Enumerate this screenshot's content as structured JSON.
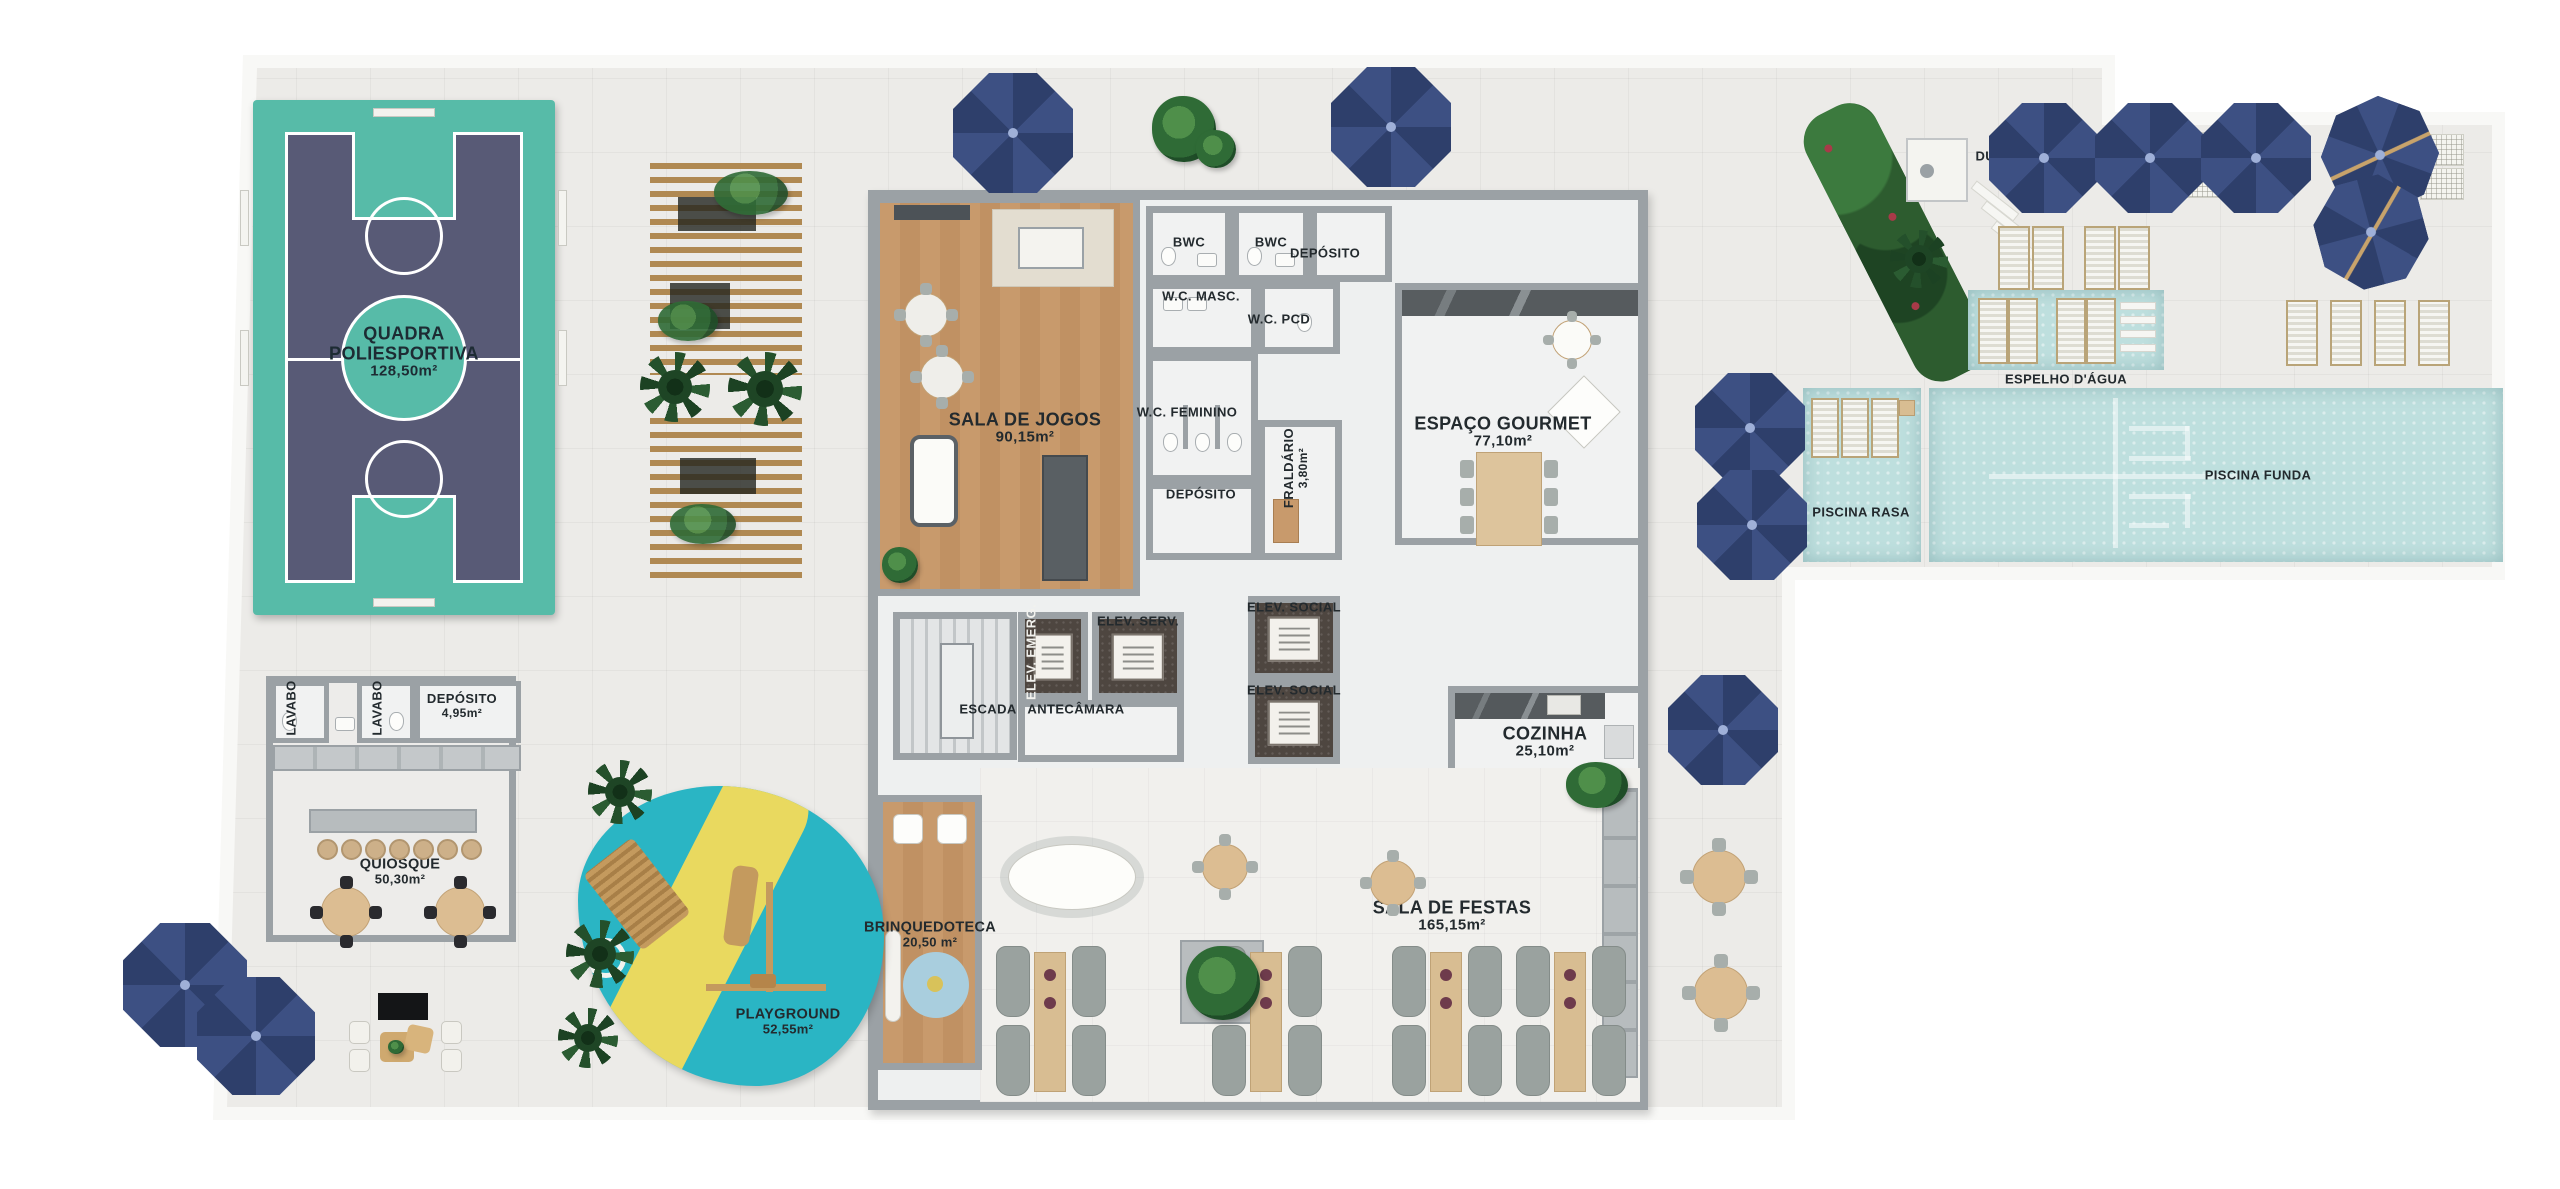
{
  "plan_title": "Pavimento de lazer - planta humanizada",
  "rooms": {
    "quadra": {
      "name": "QUADRA POLIESPORTIVA",
      "area": "128,50m²"
    },
    "sala_jogos": {
      "name": "SALA DE JOGOS",
      "area": "90,15m²"
    },
    "bwc1": {
      "name": "BWC"
    },
    "bwc2": {
      "name": "BWC"
    },
    "deposito_top": {
      "name": "DEPÓSITO"
    },
    "wc_masc": {
      "name": "W.C. MASC."
    },
    "wc_pcd": {
      "name": "W.C. PCD"
    },
    "wc_fem": {
      "name": "W.C. FEMININO"
    },
    "deposito_mid": {
      "name": "DEPÓSITO"
    },
    "fraldario": {
      "name": "FRALDÁRIO",
      "area": "3,80m²"
    },
    "espaco_gourmet": {
      "name": "ESPAÇO GOURMET",
      "area": "77,10m²"
    },
    "escada": {
      "name": "ESCADA"
    },
    "antecamara": {
      "name": "ANTECÂMARA"
    },
    "elev_emerg": {
      "name": "ELEV. EMERG."
    },
    "elev_serv": {
      "name": "ELEV. SERV."
    },
    "elev_social_1": {
      "name": "ELEV. SOCIAL"
    },
    "elev_social_2": {
      "name": "ELEV. SOCIAL"
    },
    "cozinha": {
      "name": "COZINHA",
      "area": "25,10m²"
    },
    "sala_festas": {
      "name": "SALA DE FESTAS",
      "area": "165,15m²"
    },
    "brinquedoteca": {
      "name": "BRINQUEDOTECA",
      "area": "20,50 m²"
    },
    "playground": {
      "name": "PLAYGROUND",
      "area": "52,55m²"
    },
    "quiosque": {
      "name": "QUIOSQUE",
      "area": "50,30m²"
    },
    "lavabo1": {
      "name": "LAVABO"
    },
    "lavabo2": {
      "name": "LAVABO"
    },
    "deposito_quiosque": {
      "name": "DEPÓSITO",
      "area": "4,95m²"
    },
    "ducha": {
      "name": "DUCHA"
    },
    "espelho_dagua": {
      "name": "ESPELHO D'ÁGUA"
    },
    "piscina_rasa": {
      "name": "PISCINA RASA"
    },
    "piscina_funda": {
      "name": "PISCINA FUNDA"
    }
  },
  "colors": {
    "umbrella_navy": "#35466f",
    "court_teal": "#57bba8",
    "court_purple": "#585a76",
    "pool_water": "#bedfde",
    "wood_floor": "#c89a6c",
    "playground_cyan": "#2ab5c4",
    "playground_yellow": "#e9d95f",
    "wall_gray": "#9ba1a5",
    "deck_gray": "#ecebe8",
    "label_text": "#232a2e"
  }
}
